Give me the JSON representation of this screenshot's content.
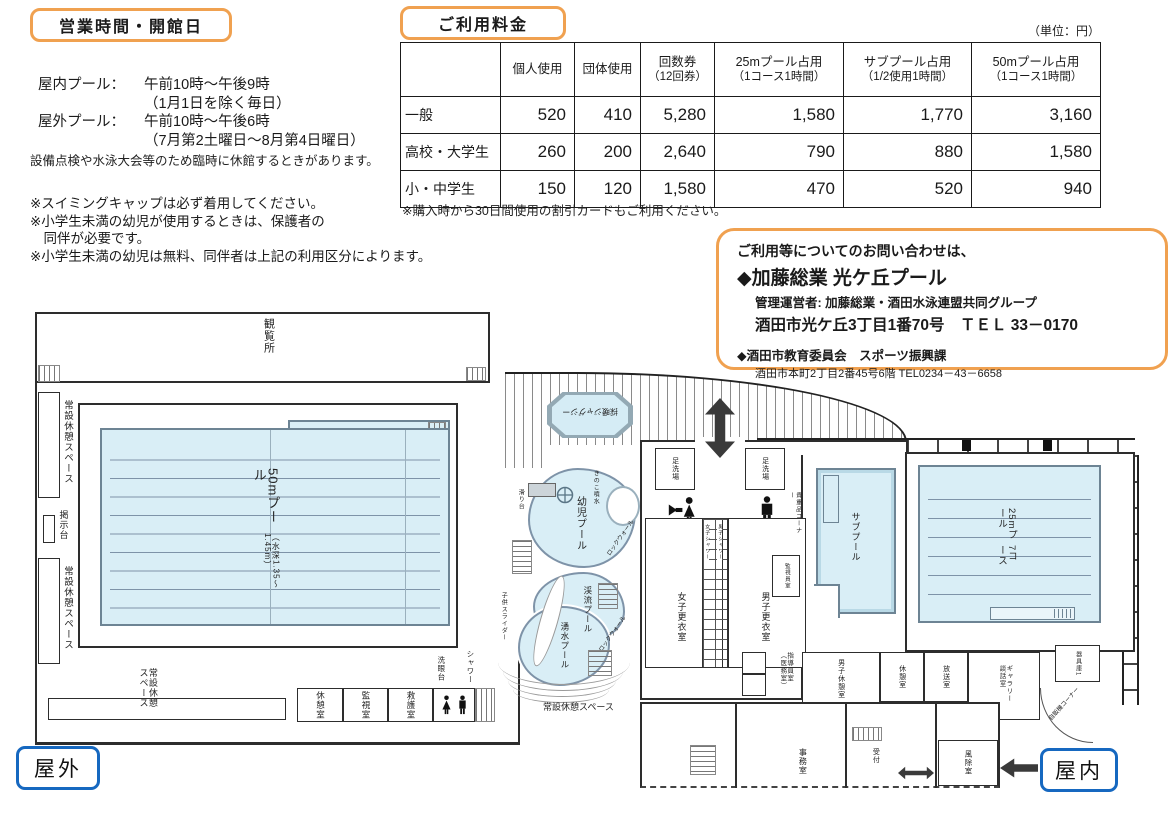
{
  "hours": {
    "title": "営業時間・開館日",
    "rows": [
      {
        "label": "屋内プール：",
        "text": "午前10時～午後9時"
      },
      {
        "label": "",
        "text": "（1月1日を除く毎日）"
      },
      {
        "label": "屋外プール：",
        "text": "午前10時～午後6時"
      },
      {
        "label": "",
        "text": "（7月第2土曜日～8月第4日曜日）"
      }
    ],
    "closure_note": "設備点検や水泳大会等のため臨時に休館するときがあります。",
    "notes": [
      "※スイミングキャップは必ず着用してください。",
      "※小学生未満の幼児が使用するときは、保護者の",
      "　同伴が必要です。",
      "※小学生未満の幼児は無料、同伴者は上記の利用区分によります。"
    ]
  },
  "fees": {
    "title": "ご利用料金",
    "unit_note": "（単位：円）",
    "columns": [
      {
        "name": "",
        "sub": ""
      },
      {
        "name": "個人使用",
        "sub": ""
      },
      {
        "name": "団体使用",
        "sub": ""
      },
      {
        "name": "回数券",
        "sub": "（12回券）"
      },
      {
        "name": "25mプール占用",
        "sub": "（1コース1時間）"
      },
      {
        "name": "サブプール占用",
        "sub": "（1/2使用1時間）"
      },
      {
        "name": "50mプール占用",
        "sub": "（1コース1時間）"
      }
    ],
    "rows": [
      {
        "label": "一般",
        "values": [
          "520",
          "410",
          "5,280",
          "1,580",
          "1,770",
          "3,160"
        ]
      },
      {
        "label": "高校・大学生",
        "values": [
          "260",
          "200",
          "2,640",
          "790",
          "880",
          "1,580"
        ]
      },
      {
        "label": "小・中学生",
        "values": [
          "150",
          "120",
          "1,580",
          "470",
          "520",
          "940"
        ]
      }
    ],
    "note": "※購入時から30日間使用の割引カードもご利用ください。"
  },
  "contact": {
    "intro": "ご利用等についてのお問い合わせは、",
    "primary_name": "◆加藤総業 光ケ丘プール",
    "operator": "管理運営者: 加藤総業・酒田水泳連盟共同グループ",
    "address_tel": "酒田市光ケ丘3丁目1番70号　ＴＥＬ 33－0170",
    "secondary_name": "◆酒田市教育委員会　スポーツ振興課",
    "secondary_address": "酒田市本町2丁目2番45号6階 TEL0234－43－6658"
  },
  "floorplan": {
    "outdoor": {
      "gallery": "観覧所",
      "pool50_name": "50mプール",
      "pool50_depth": "（水深1.35～1.45m）",
      "rest_space_left_1": "常設休憩スペース",
      "rest_space_left_2": "常設休憩スペース",
      "rest_space_bottom": "常設休憩スペース",
      "rest_space_center": "常設休憩スペース",
      "notice_board": "掲示台",
      "rest_room": "休憩室",
      "watch_room": "監視室",
      "first_aid_room": "救護室",
      "eye_wash": "洗眼台",
      "shower": "シャワー",
      "jacuzzi": "採暖ジャグジー",
      "toddler_pool": "幼児プール",
      "mushroom_fountain": "きのこ噴水",
      "slide": "滑り台",
      "rock_wall_1": "ロックウォール",
      "rock_wall_2": "ロックウォール",
      "stream_pool": "渓流プール",
      "spring_pool": "湧水プール",
      "kids_slider": "子供スライダー"
    },
    "indoor": {
      "foot_wash_left": "足洗場",
      "foot_wash_right": "足洗場",
      "womens_toilet": "女子便所",
      "mens_toilet": "男子便所",
      "womens_changing": "女子更衣室",
      "mens_changing": "男子更衣室",
      "womens_shower": "女子シャワー",
      "mens_shower": "男子シャワー",
      "valuables_corner": "貴重品コーナー",
      "monitor_room": "監視員室",
      "sub_pool": "サブプール",
      "pool25_name": "25mプール",
      "pool25_courses": "7コース",
      "instructor_room": "指導員室（医務室）",
      "mens_rest_room": "男子休憩室",
      "rest_room": "休憩室",
      "broadcast_room": "放送室",
      "gallery_lounge": "ギャラリー談話室",
      "equipment_room": "器具庫1",
      "vending_corner": "自販機コーナー",
      "office": "事務室",
      "reception": "受付",
      "windbreak_room": "風除室"
    },
    "badges": {
      "outdoor": "屋外",
      "indoor": "屋内"
    }
  },
  "colors": {
    "accent_orange": "#f0a150",
    "accent_blue": "#1668c0",
    "pool_fill": "#d9eef6",
    "wall": "#2d2d2d"
  }
}
